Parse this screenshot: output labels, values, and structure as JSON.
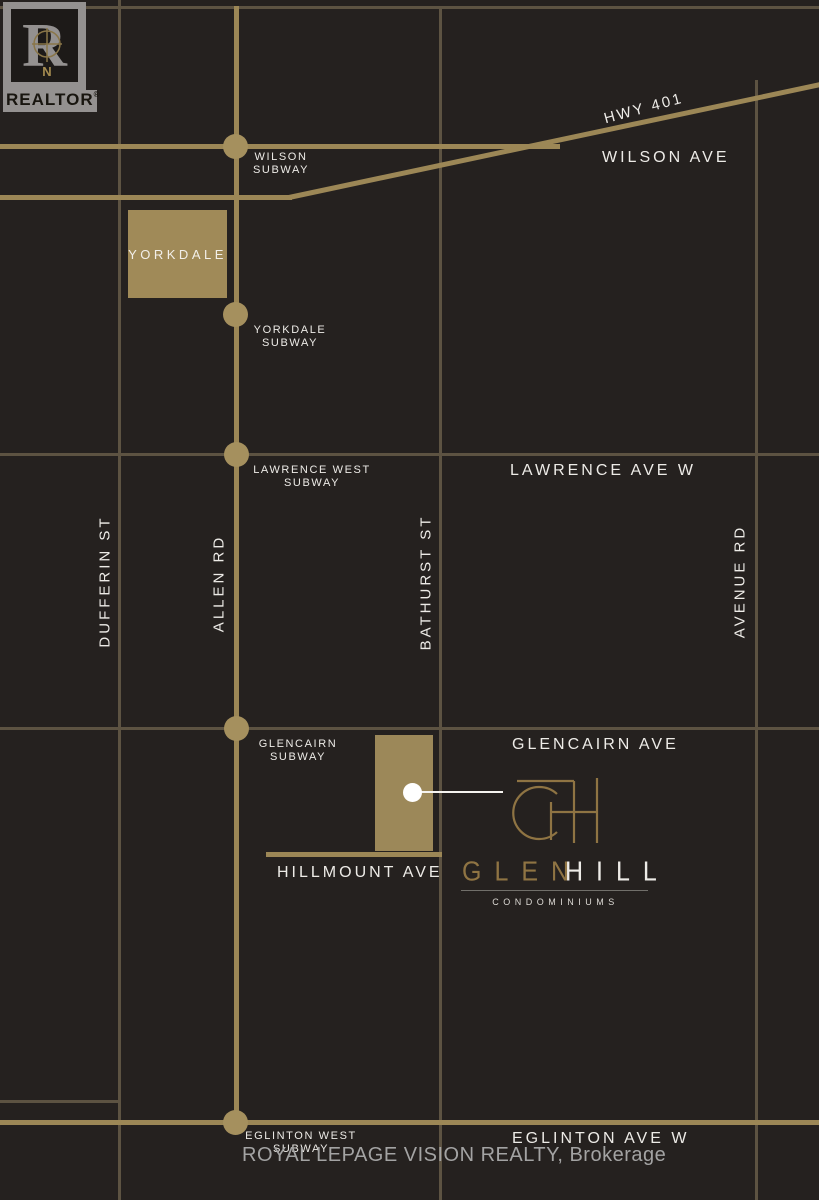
{
  "map": {
    "realtor": {
      "label": "REALTOR",
      "reg": "®",
      "r_letter": "R",
      "compass_n": "N"
    },
    "highway": {
      "label": "HWY 401"
    },
    "streets_horizontal": [
      {
        "label": "WILSON AVE"
      },
      {
        "label": "LAWRENCE AVE W"
      },
      {
        "label": "GLENCAIRN AVE"
      },
      {
        "label": "HILLMOUNT AVE"
      },
      {
        "label": "EGLINTON AVE W"
      }
    ],
    "streets_vertical": [
      {
        "label": "DUFFERIN ST"
      },
      {
        "label": "ALLEN RD"
      },
      {
        "label": "BATHURST ST"
      },
      {
        "label": "AVENUE RD"
      }
    ],
    "stations": [
      {
        "line1": "WILSON",
        "line2": "SUBWAY"
      },
      {
        "line1": "YORKDALE",
        "line2": "SUBWAY"
      },
      {
        "line1": "LAWRENCE WEST",
        "line2": "SUBWAY"
      },
      {
        "line1": "GLENCAIRN",
        "line2": "SUBWAY"
      },
      {
        "line1": "EGLINTON WEST",
        "line2": "SUBWAY"
      }
    ],
    "landmarks": {
      "yorkdale": "YORKDALE"
    },
    "brand": {
      "name_part1": "GLEN",
      "name_part2": "HILL",
      "subtitle": "CONDOMINIUMS"
    },
    "footer": {
      "brokerage": "ROYAL LEPAGE VISION REALTY, Brokerage"
    },
    "colors": {
      "background": "#25211f",
      "gold": "#9c8756",
      "gold_bright": "#a5905e",
      "minor_road": "#5d5342",
      "white": "#edebe7",
      "glen_gold": "#8f7443",
      "logo_gray": "#949190"
    }
  }
}
